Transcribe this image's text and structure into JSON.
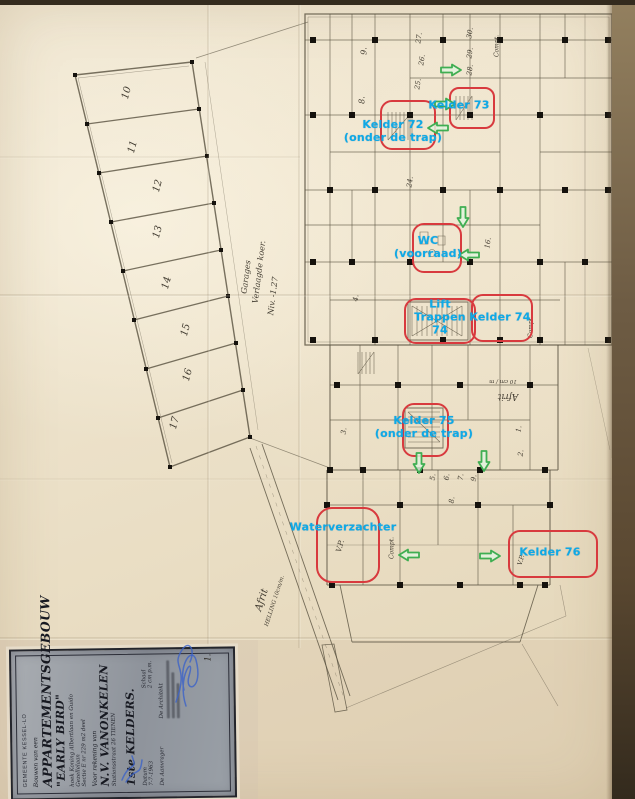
{
  "document": {
    "kind": "scanned basement floor plan",
    "sheet_number": "1."
  },
  "colors": {
    "annotation": "#0ea9e6",
    "highlight": "#d83a3e",
    "arrow_stroke": "#3fae52",
    "arrow_fill": "#e2f3de",
    "ink": "#4f4a40",
    "paper": "#ece1c9",
    "signature": "#3c63c8"
  },
  "title_block": {
    "municipality": "GEMEENTE KESSEL-LO",
    "project_prefix": "Bouwen van een",
    "project_name": "APPARTEMENTSGEBOUW",
    "project_sub": "\"EARLY BIRD\"",
    "address_line1": "hoek Koning Albertlaan en Guido Gezellelaan",
    "address_line2": "Sectie E nr 229 m2 deel",
    "client_prefix": "Voor rekening van",
    "client_name": "N.V. VANONKELEN",
    "client_address": "Stationsstraat 26 TIENEN",
    "sheet_title": "1ste KELDERS.",
    "datum_label": "Datum",
    "datum_value": "7-7-1963",
    "schaal_label": "Schaal",
    "schaal_value": "2 cm p.m.",
    "aanvrager_label": "De Aanvrager",
    "architect_label": "De Architekt"
  },
  "annotations": [
    {
      "name": "kelder-72",
      "lines": [
        "Kelder 72",
        "(onder de trap)"
      ],
      "x": 393,
      "y": 131
    },
    {
      "name": "kelder-73",
      "lines": [
        "Kelder 73"
      ],
      "x": 459,
      "y": 105
    },
    {
      "name": "wc-voorraad",
      "lines": [
        "WC",
        "(voorraad)"
      ],
      "x": 428,
      "y": 247
    },
    {
      "name": "lift-trappen-74",
      "lines": [
        "Lift",
        "Trappen",
        "74"
      ],
      "x": 440,
      "y": 317
    },
    {
      "name": "kelder-74",
      "lines": [
        "Kelder 74"
      ],
      "x": 500,
      "y": 317
    },
    {
      "name": "kelder-75",
      "lines": [
        "Kelder 75",
        "(onder de trap)"
      ],
      "x": 424,
      "y": 427
    },
    {
      "name": "waterverzachter",
      "lines": [
        "Waterverzachter"
      ],
      "x": 343,
      "y": 527
    },
    {
      "name": "kelder-76",
      "lines": [
        "Kelder 76"
      ],
      "x": 550,
      "y": 552
    }
  ],
  "highlights": [
    {
      "name": "kelder-72-box",
      "x": 380,
      "y": 100,
      "w": 52,
      "h": 46,
      "rx": 12
    },
    {
      "name": "kelder-73-box",
      "x": 449,
      "y": 87,
      "w": 42,
      "h": 38,
      "rx": 10
    },
    {
      "name": "wc-box",
      "x": 412,
      "y": 223,
      "w": 46,
      "h": 46,
      "rx": 12
    },
    {
      "name": "lift-trappen-box",
      "x": 404,
      "y": 298,
      "w": 68,
      "h": 42,
      "rx": 12
    },
    {
      "name": "kelder-74-box",
      "x": 471,
      "y": 294,
      "w": 58,
      "h": 44,
      "rx": 12
    },
    {
      "name": "kelder-75-box",
      "x": 402,
      "y": 403,
      "w": 43,
      "h": 50,
      "rx": 12
    },
    {
      "name": "waterverzachter-box",
      "x": 316,
      "y": 507,
      "w": 60,
      "h": 72,
      "rx": 16
    },
    {
      "name": "kelder-76-box",
      "x": 508,
      "y": 530,
      "w": 86,
      "h": 44,
      "rx": 12
    }
  ],
  "arrows": [
    {
      "dir": "right",
      "x": 440,
      "y": 62
    },
    {
      "dir": "right",
      "x": 434,
      "y": 96
    },
    {
      "dir": "left",
      "x": 427,
      "y": 120
    },
    {
      "dir": "down",
      "x": 456,
      "y": 206
    },
    {
      "dir": "left",
      "x": 458,
      "y": 247
    },
    {
      "dir": "down",
      "x": 412,
      "y": 452
    },
    {
      "dir": "down",
      "x": 477,
      "y": 450
    },
    {
      "dir": "left",
      "x": 398,
      "y": 547
    },
    {
      "dir": "right",
      "x": 479,
      "y": 548
    }
  ],
  "plan_labels": [
    {
      "t": "Garages",
      "x": 246,
      "y": 277,
      "r": -83,
      "s": 8
    },
    {
      "t": "Verlaagde koer.",
      "x": 259,
      "y": 272,
      "r": -83,
      "s": 8
    },
    {
      "t": "Niv. -1.27",
      "x": 273,
      "y": 296,
      "r": -83,
      "s": 8
    },
    {
      "t": "Afrit",
      "x": 262,
      "y": 600,
      "r": -72,
      "s": 10
    },
    {
      "t": "HELLING 10cm/m.",
      "x": 275,
      "y": 601,
      "r": -72,
      "s": 5.5
    },
    {
      "t": "Afrit",
      "x": 508,
      "y": 396,
      "r": 180,
      "s": 9
    },
    {
      "t": "10 cm / m",
      "x": 503,
      "y": 381,
      "r": 180,
      "s": 5.5
    },
    {
      "t": "Compt.",
      "x": 497,
      "y": 46,
      "r": -90,
      "s": 6
    },
    {
      "t": "Compt.",
      "x": 531,
      "y": 327,
      "r": -90,
      "s": 6
    },
    {
      "t": "Compt.",
      "x": 392,
      "y": 548,
      "r": -90,
      "s": 6
    },
    {
      "t": "V.P.",
      "x": 340,
      "y": 546,
      "r": -75,
      "s": 7.5
    },
    {
      "t": "V.P.",
      "x": 521,
      "y": 560,
      "r": -75,
      "s": 6.5
    }
  ],
  "room_numbers": [
    {
      "t": "10",
      "x": 127,
      "y": 93,
      "r": -75,
      "s": 10
    },
    {
      "t": "11",
      "x": 133,
      "y": 147,
      "r": -75,
      "s": 10
    },
    {
      "t": "12",
      "x": 158,
      "y": 186,
      "r": -75,
      "s": 10
    },
    {
      "t": "13",
      "x": 158,
      "y": 232,
      "r": -75,
      "s": 10
    },
    {
      "t": "14",
      "x": 167,
      "y": 283,
      "r": -75,
      "s": 10
    },
    {
      "t": "15",
      "x": 186,
      "y": 330,
      "r": -75,
      "s": 10
    },
    {
      "t": "16",
      "x": 188,
      "y": 375,
      "r": -75,
      "s": 10
    },
    {
      "t": "17",
      "x": 175,
      "y": 423,
      "r": -75,
      "s": 10
    },
    {
      "t": "9.",
      "x": 364,
      "y": 51,
      "r": -90,
      "s": 8
    },
    {
      "t": "8.",
      "x": 362,
      "y": 100,
      "r": -90,
      "s": 8
    },
    {
      "t": "27.",
      "x": 419,
      "y": 38,
      "r": -82,
      "s": 7
    },
    {
      "t": "26.",
      "x": 422,
      "y": 60,
      "r": -82,
      "s": 7
    },
    {
      "t": "25.",
      "x": 418,
      "y": 84,
      "r": -82,
      "s": 7
    },
    {
      "t": "24.",
      "x": 410,
      "y": 182,
      "r": -82,
      "s": 7
    },
    {
      "t": "30.",
      "x": 470,
      "y": 33,
      "r": -82,
      "s": 7
    },
    {
      "t": "29.",
      "x": 470,
      "y": 53,
      "r": -82,
      "s": 7
    },
    {
      "t": "28.",
      "x": 470,
      "y": 70,
      "r": -82,
      "s": 7
    },
    {
      "t": "16.",
      "x": 488,
      "y": 243,
      "r": -82,
      "s": 7
    },
    {
      "t": "4.",
      "x": 356,
      "y": 298,
      "r": -82,
      "s": 7
    },
    {
      "t": "3.",
      "x": 344,
      "y": 431,
      "r": -82,
      "s": 7
    },
    {
      "t": "1.",
      "x": 519,
      "y": 429,
      "r": -82,
      "s": 7
    },
    {
      "t": "2.",
      "x": 521,
      "y": 453,
      "r": -82,
      "s": 7
    },
    {
      "t": "5.",
      "x": 433,
      "y": 477,
      "r": -82,
      "s": 7
    },
    {
      "t": "6.",
      "x": 447,
      "y": 477,
      "r": -82,
      "s": 7
    },
    {
      "t": "7.",
      "x": 461,
      "y": 477,
      "r": -82,
      "s": 7
    },
    {
      "t": "8.",
      "x": 452,
      "y": 500,
      "r": -82,
      "s": 7
    },
    {
      "t": "9.",
      "x": 474,
      "y": 478,
      "r": -82,
      "s": 7
    }
  ]
}
